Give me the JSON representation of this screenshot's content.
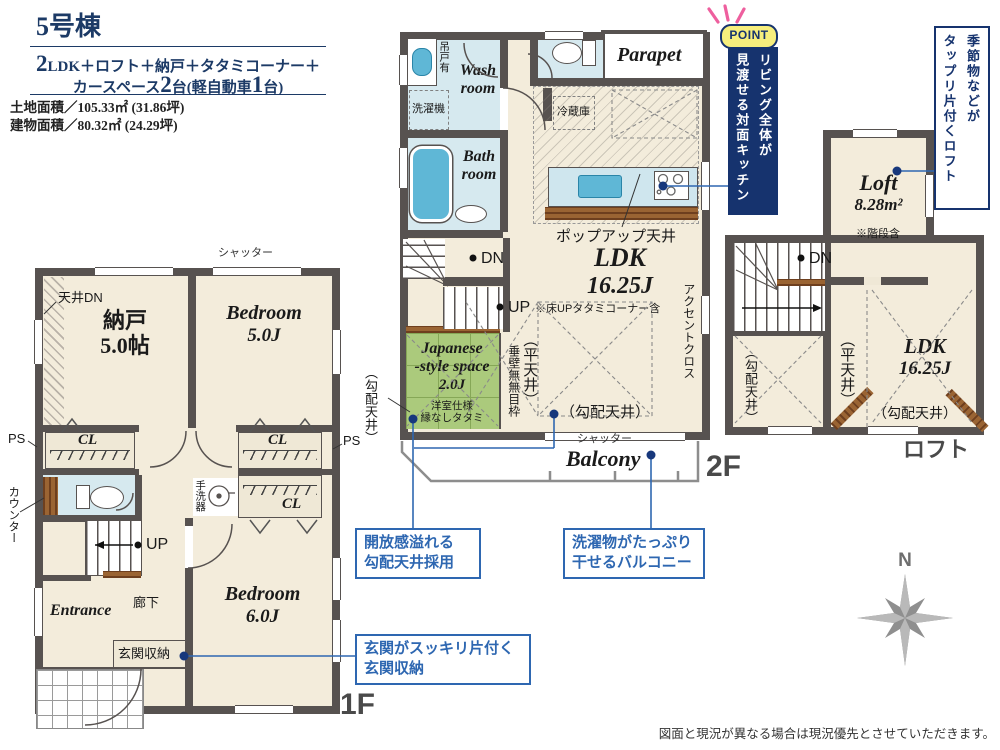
{
  "header": {
    "title": "5号棟",
    "spec_num1": "2",
    "spec_line1": "LDK＋ロフト＋納戸＋タタミコーナー＋",
    "spec_pre": "カースペース",
    "spec_num2": "2",
    "spec_mid": "台(軽自動車",
    "spec_num3": "1",
    "spec_post": "台)",
    "land": "土地面積／105.33㎡ (31.86坪)",
    "building": "建物面積／80.32㎡ (24.29坪)"
  },
  "f1": {
    "floor": "1F",
    "shutter": "シャッター",
    "tenjo_dn": "天井DN",
    "nando": "納戸",
    "nando_size": "5.0帖",
    "bed5": "Bedroom",
    "bed5_size": "5.0J",
    "cl": "CL",
    "ps": "PS",
    "counter": "カウンター",
    "up": "UP",
    "tearai": "手洗器",
    "bed6": "Bedroom",
    "bed6_size": "6.0J",
    "entrance": "Entrance",
    "rouka": "廊下",
    "genkan": "玄関収納"
  },
  "f2": {
    "floor": "2F",
    "tsurido": "吊戸有",
    "wash": "Wash room",
    "laundry": "洗濯機",
    "parapet": "Parapet",
    "bath": "Bath room",
    "fridge": "冷蔵庫",
    "popup": "ポップアップ天井",
    "ldk": "LDK",
    "ldk_size": "16.25J",
    "note": "※床UPタタミコーナー含",
    "dn": "DN",
    "up": "UP",
    "jroom1": "Japanese",
    "jroom2": "-style space",
    "jroom_size": "2.0J",
    "jnote1": "洋室仕様",
    "jnote2": "縁なしタタミ",
    "tarekabe": "垂壁無無目枠",
    "hira": "（平天井）",
    "kobai": "（勾配天井）",
    "kobai_left": "（勾配天井）",
    "accent": "アクセントクロス",
    "shutter": "シャッター",
    "balcony": "Balcony"
  },
  "loft": {
    "floor": "ロフト",
    "name": "Loft",
    "area": "8.28m²",
    "note": "※階段含",
    "dn": "DN",
    "kobai_l": "（勾配天井）",
    "hira": "（平天井）",
    "ldk": "LDK",
    "ldk_size": "16.25J",
    "kobai_b": "（勾配天井）"
  },
  "point": {
    "badge": "POINT",
    "l1": "リビング全体が",
    "l2": "見渡せる対面キッチン"
  },
  "loft_note": {
    "l1": "季節物などが",
    "l2": "タップリ片付くロフト"
  },
  "callouts": {
    "c1a": "開放感溢れる",
    "c1b": "勾配天井採用",
    "c2a": "洗濯物がたっぷり",
    "c2b": "干せるバルコニー",
    "c3a": "玄関がスッキリ片付く",
    "c3b": "玄関収納"
  },
  "compass": {
    "n": "N"
  },
  "footer": {
    "disclaimer": "図面と現況が異なる場合は現況優先とさせていただきます。"
  },
  "colors": {
    "navy": "#16336e",
    "callout_blue": "#2e67b1",
    "room_beige": "#f3ecdb",
    "wet_blue": "#d6e9ef",
    "fixture_blue": "#5fb7d6",
    "tatami_green": "#abca7c",
    "wall_gray": "#575250",
    "wood_brown": "#8a5a33",
    "point_yellow": "#f6ee7d",
    "spark_pink": "#ee5f9e"
  }
}
